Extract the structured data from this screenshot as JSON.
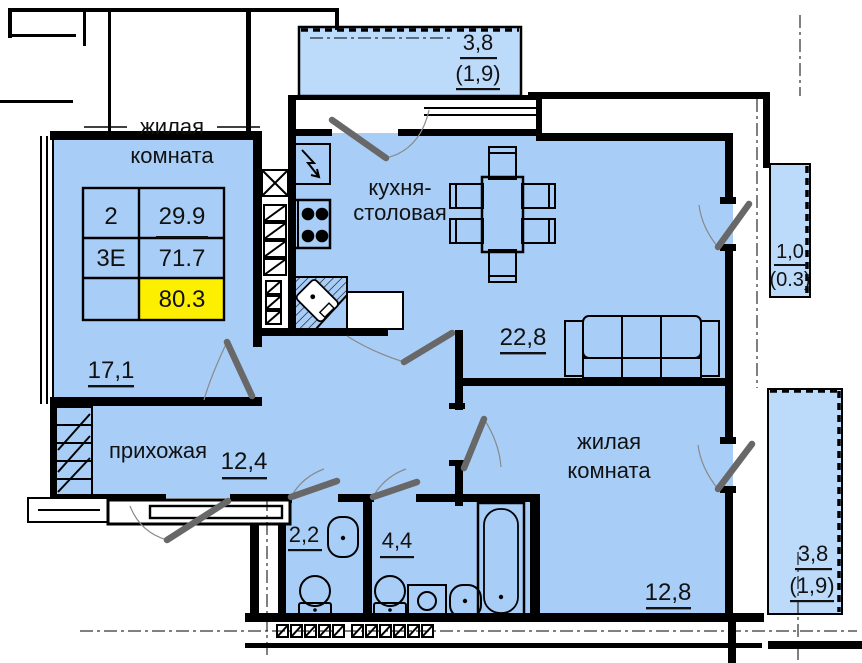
{
  "colors": {
    "room_fill": "#a8cef8",
    "balcony_fill": "#bcdafa",
    "highlight_fill": "#fdef00",
    "wall": "#000000",
    "door_leaf": "#686868"
  },
  "info_table": {
    "row1": {
      "left": "2",
      "right": "29.9"
    },
    "row2": {
      "left": "3Е",
      "right": "71.7"
    },
    "row3": {
      "left": "",
      "right": "80.3"
    }
  },
  "rooms": {
    "living1": {
      "name_line1": "жилая",
      "name_line2": "комната",
      "area": "17,1"
    },
    "kitchen": {
      "name_line1": "кухня-",
      "name_line2": "столовая",
      "area": "22,8"
    },
    "hallway": {
      "name": "прихожая",
      "area": "12,4"
    },
    "living2": {
      "name_line1": "жилая",
      "name_line2": "комната",
      "area": "12,8"
    },
    "wc": {
      "area": "2,2"
    },
    "bathroom": {
      "area": "4,4"
    }
  },
  "balconies": {
    "top": {
      "area": "3,8",
      "reduced": "(1,9)"
    },
    "right": {
      "area": "1,0",
      "reduced": "(0.3)"
    },
    "bottom": {
      "area": "3,8",
      "reduced": "(1,9)"
    }
  }
}
